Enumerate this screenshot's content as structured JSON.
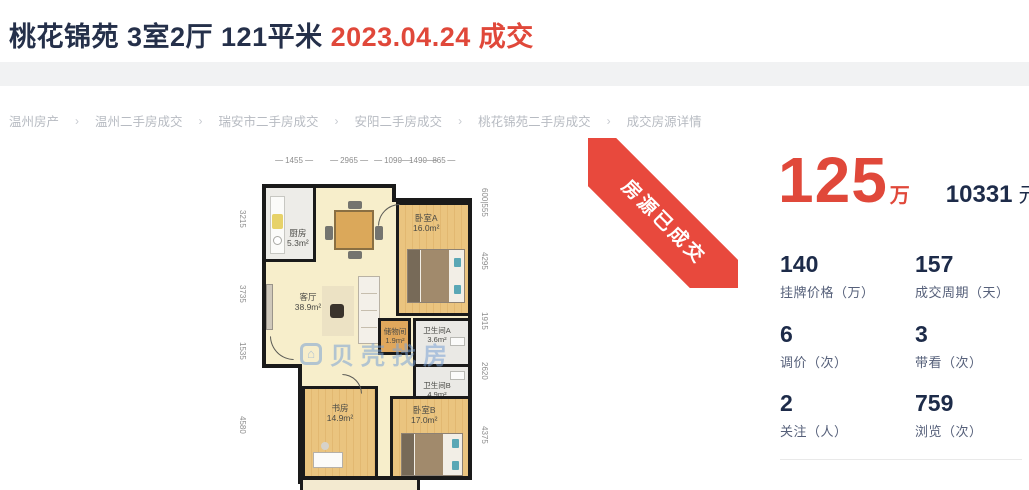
{
  "header": {
    "title_main": "桃花锦苑 3室2厅 121平米",
    "title_deal": "2023.04.24 成交"
  },
  "breadcrumb": {
    "separator": "›",
    "items": [
      "温州房产",
      "温州二手房成交",
      "瑞安市二手房成交",
      "安阳二手房成交",
      "桃花锦苑二手房成交",
      "成交房源详情"
    ]
  },
  "ribbon": {
    "label": "房源已成交",
    "color": "#e8493d"
  },
  "price": {
    "total_value": "125",
    "total_unit": "万",
    "unit_value": "10331",
    "unit_unit": "元/平",
    "accent_color": "#e0483a"
  },
  "stats": [
    {
      "value": "140",
      "label": "挂牌价格（万）"
    },
    {
      "value": "157",
      "label": "成交周期（天）"
    },
    {
      "value": "6",
      "label": "调价（次）"
    },
    {
      "value": "3",
      "label": "带看（次）"
    },
    {
      "value": "2",
      "label": "关注（人）"
    },
    {
      "value": "759",
      "label": "浏览（次）"
    }
  ],
  "floorplan": {
    "watermark": "贝壳找房",
    "dims_top": [
      "1455",
      "2965",
      "1090",
      "1490",
      "865"
    ],
    "dims_left": [
      "3215",
      "3735",
      "1535",
      "4580"
    ],
    "dims_right": [
      "600|555",
      "4295",
      "1915",
      "2620",
      "4375"
    ],
    "rooms": [
      {
        "name": "厨房",
        "area": "5.3m²"
      },
      {
        "name": "客厅",
        "area": "38.9m²"
      },
      {
        "name": "卧室A",
        "area": "16.0m²"
      },
      {
        "name": "储物间",
        "area": "1.9m²"
      },
      {
        "name": "卫生间A",
        "area": "3.6m²"
      },
      {
        "name": "卫生间B",
        "area": "4.9m²"
      },
      {
        "name": "书房",
        "area": "14.9m²"
      },
      {
        "name": "卧室B",
        "area": "17.0m²"
      }
    ],
    "wall_color": "#1a1a1a",
    "floor_cream": "#f7eecb",
    "floor_wood": "#eac47f"
  }
}
